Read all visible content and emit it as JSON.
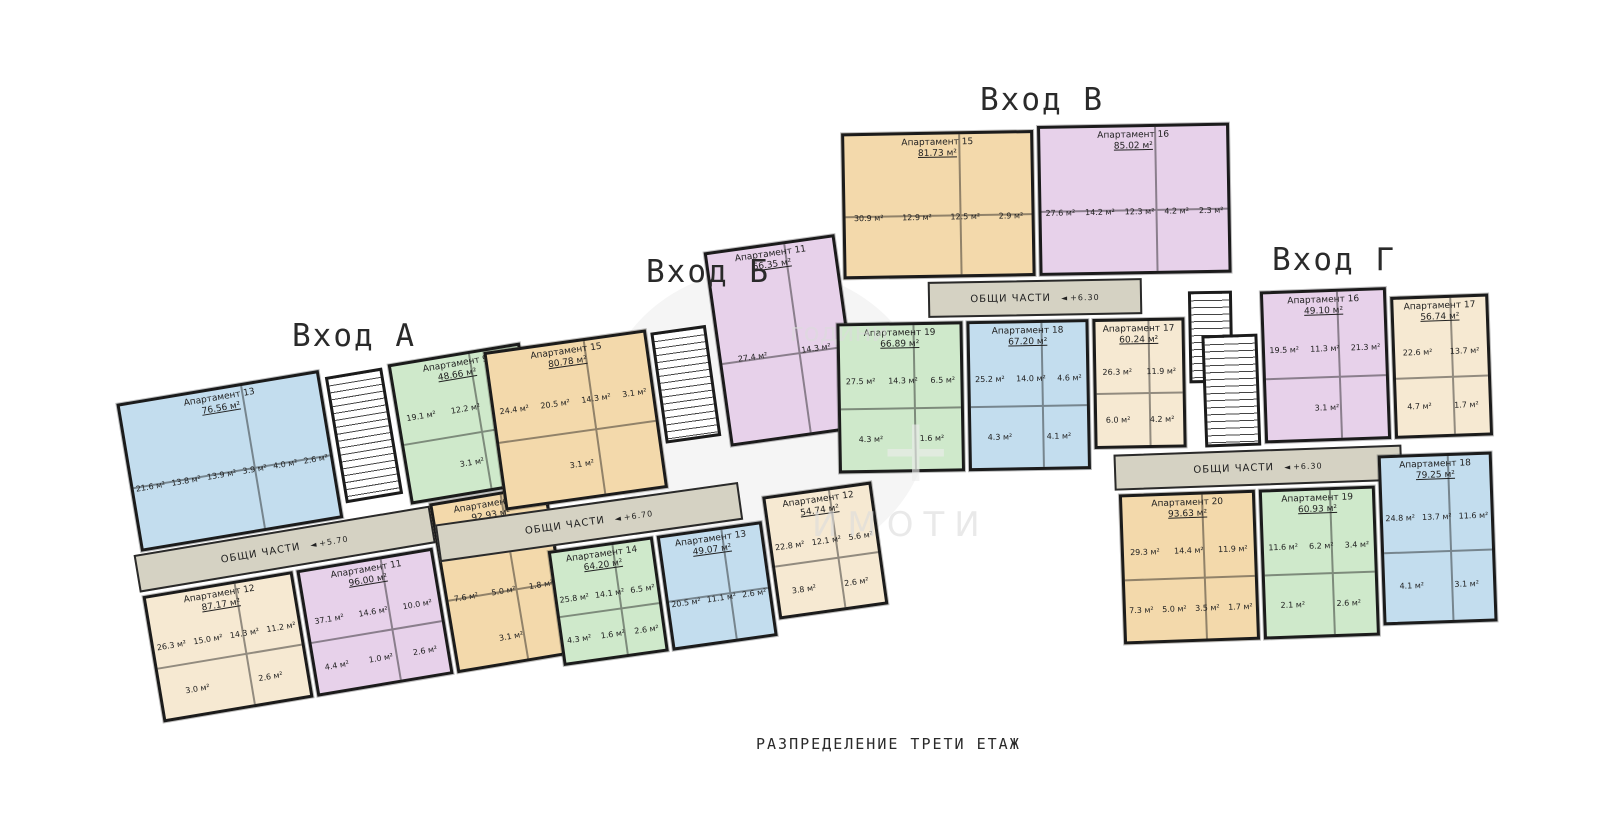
{
  "page": {
    "caption": "РАЗПРЕДЕЛЕНИЕ ТРЕТИ ЕТАЖ"
  },
  "watermark": {
    "line1": "години",
    "line2": "ИМОТИ",
    "symbol": "+"
  },
  "palette": {
    "blue": "#c3ddee",
    "green": "#cfe9cb",
    "purple": "#e7d1ea",
    "cream": "#f6e9d2",
    "tan": "#f3d9ab",
    "corridor": "#d5d2c3",
    "wall": "#1b1b1b"
  },
  "sections": [
    {
      "id": "A",
      "title": "Вход А",
      "common": {
        "label": "ОБЩИ ЧАСТИ",
        "elevation": "+5.70"
      },
      "apartments": [
        {
          "name": "Апартамент 13",
          "area": "76.56 м²",
          "color": "#c3ddee",
          "rooms": [
            "21.6 м²",
            "13.8 м²",
            "13.9 м²",
            "3.9 м²",
            "4.0 м²",
            "2.6 м²"
          ]
        },
        {
          "name": "Апартамент 9",
          "area": "48.66 м²",
          "color": "#cfe9cb",
          "rooms": [
            "19.1 м²",
            "12.2 м²",
            "3.9 м²",
            "3.1 м²"
          ]
        },
        {
          "name": "Апартамент 12",
          "area": "87.17 м²",
          "color": "#f6e9d2",
          "rooms": [
            "26.3 м²",
            "15.0 м²",
            "14.3 м²",
            "11.2 м²",
            "3.0 м²",
            "2.6 м²"
          ]
        },
        {
          "name": "Апартамент 11",
          "area": "96.00 м²",
          "color": "#e7d1ea",
          "rooms": [
            "37.1 м²",
            "14.6 м²",
            "10.0 м²",
            "4.4 м²",
            "1.0 м²",
            "2.6 м²"
          ]
        },
        {
          "name": "Апартамент 10",
          "area": "92.93 м²",
          "color": "#f3d9ab",
          "rooms": [
            "20.5 м²",
            "14.5 м²",
            "12.5 м²",
            "7.6 м²",
            "5.0 м²",
            "1.8 м²",
            "3.1 м²"
          ]
        }
      ]
    },
    {
      "id": "B",
      "title": "Вход Б",
      "common": {
        "label": "ОБЩИ ЧАСТИ",
        "elevation": "+6.70"
      },
      "apartments": [
        {
          "name": "Апартамент 15",
          "area": "80.78 м²",
          "color": "#f3d9ab",
          "rooms": [
            "24.4 м²",
            "20.5 м²",
            "14.3 м²",
            "3.1 м²",
            "3.1 м²"
          ]
        },
        {
          "name": "Апартамент 11",
          "area": "66.35 м²",
          "color": "#e7d1ea",
          "rooms": [
            "27.4 м²",
            "14.3 м²"
          ]
        },
        {
          "name": "Апартамент 14",
          "area": "64.20 м²",
          "color": "#cfe9cb",
          "rooms": [
            "25.8 м²",
            "14.1 м²",
            "6.5 м²",
            "4.3 м²",
            "1.6 м²",
            "2.6 м²"
          ]
        },
        {
          "name": "Апартамент 13",
          "area": "49.07 м²",
          "color": "#c3ddee",
          "rooms": [
            "20.5 м²",
            "11.1 м²",
            "2.6 м²"
          ]
        },
        {
          "name": "Апартамент 12",
          "area": "54.74 м²",
          "color": "#f6e9d2",
          "rooms": [
            "22.8 м²",
            "12.1 м²",
            "5.6 м²",
            "3.8 м²",
            "2.6 м²"
          ]
        }
      ]
    },
    {
      "id": "V",
      "title": "Вход В",
      "common": {
        "label": "ОБЩИ ЧАСТИ",
        "elevation": "+6.30"
      },
      "apartments": [
        {
          "name": "Апартамент 15",
          "area": "81.73 м²",
          "color": "#f3d9ab",
          "rooms": [
            "30.9 м²",
            "12.9 м²",
            "12.5 м²",
            "2.9 м²"
          ]
        },
        {
          "name": "Апартамент 16",
          "area": "85.02 м²",
          "color": "#e7d1ea",
          "rooms": [
            "27.6 м²",
            "14.2 м²",
            "12.3 м²",
            "4.2 м²",
            "2.3 м²"
          ]
        },
        {
          "name": "Апартамент 19",
          "area": "66.89 м²",
          "color": "#cfe9cb",
          "rooms": [
            "27.5 м²",
            "14.3 м²",
            "6.5 м²",
            "4.3 м²",
            "1.6 м²"
          ]
        },
        {
          "name": "Апартамент 18",
          "area": "67.20 м²",
          "color": "#c3ddee",
          "rooms": [
            "25.2 м²",
            "14.0 м²",
            "4.6 м²",
            "4.3 м²",
            "4.1 м²"
          ]
        },
        {
          "name": "Апартамент 17",
          "area": "60.24 м²",
          "color": "#f6e9d2",
          "rooms": [
            "26.3 м²",
            "11.9 м²",
            "6.0 м²",
            "4.2 м²"
          ]
        }
      ]
    },
    {
      "id": "G",
      "title": "Вход Г",
      "common": {
        "label": "ОБЩИ ЧАСТИ",
        "elevation": "+6.30"
      },
      "apartments": [
        {
          "name": "Апартамент 16",
          "area": "49.10 м²",
          "color": "#e7d1ea",
          "rooms": [
            "19.5 м²",
            "11.3 м²",
            "21.3 м²",
            "3.1 м²"
          ]
        },
        {
          "name": "Апартамент 17",
          "area": "56.74 м²",
          "color": "#f6e9d2",
          "rooms": [
            "22.6 м²",
            "13.7 м²",
            "4.7 м²",
            "1.7 м²"
          ]
        },
        {
          "name": "Апартамент 20",
          "area": "93.63 м²",
          "color": "#f3d9ab",
          "rooms": [
            "29.3 м²",
            "14.4 м²",
            "11.9 м²",
            "7.3 м²",
            "5.0 м²",
            "3.5 м²",
            "1.7 м²"
          ]
        },
        {
          "name": "Апартамент 19",
          "area": "60.93 м²",
          "color": "#cfe9cb",
          "rooms": [
            "11.6 м²",
            "6.2 м²",
            "3.4 м²",
            "2.1 м²",
            "2.6 м²"
          ]
        },
        {
          "name": "Апартамент 18",
          "area": "79.25 м²",
          "color": "#c3ddee",
          "rooms": [
            "24.8 м²",
            "13.7 м²",
            "11.6 м²",
            "4.1 м²",
            "3.1 м²"
          ]
        }
      ]
    }
  ]
}
